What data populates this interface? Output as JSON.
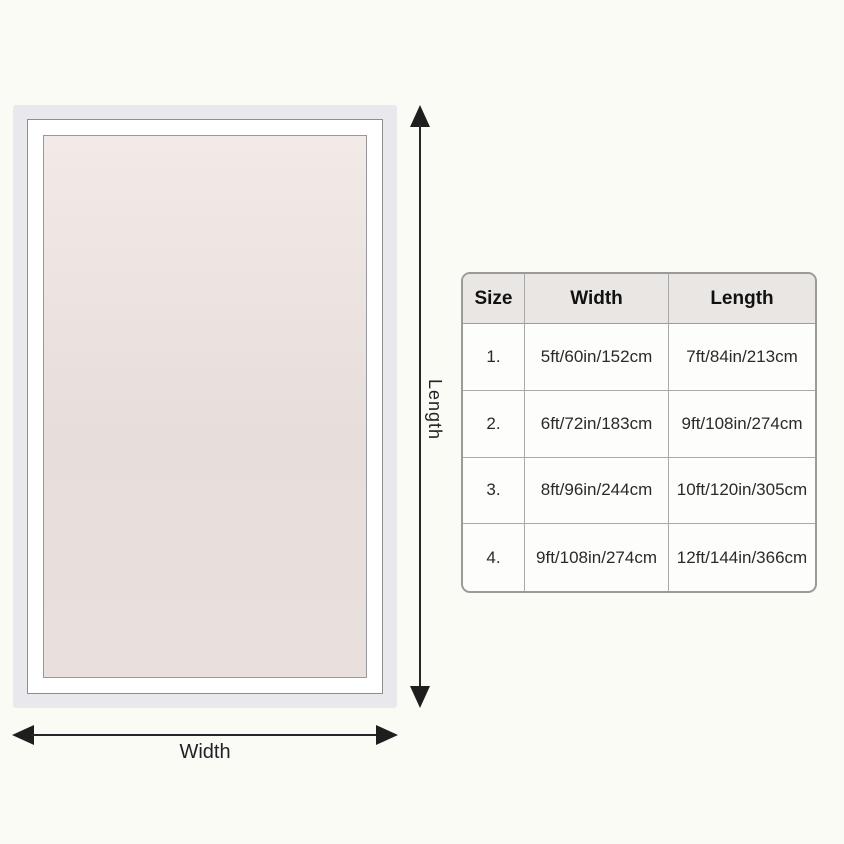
{
  "page": {
    "background": "#fbfbf5"
  },
  "diagram": {
    "length_label": "Length",
    "width_label": "Width",
    "colors": {
      "outer_band": "#e9e9ed",
      "middle_band": "#ffffff",
      "inner_fill": "#ece2df",
      "frame_line": "#8d8d92",
      "arrow": "#1e1e1e"
    }
  },
  "size_table": {
    "headers": [
      "Size",
      "Width",
      "Length"
    ],
    "rows": [
      {
        "size": "1.",
        "width": "5ft/60in/152cm",
        "length": "7ft/84in/213cm"
      },
      {
        "size": "2.",
        "width": "6ft/72in/183cm",
        "length": "9ft/108in/274cm"
      },
      {
        "size": "3.",
        "width": "8ft/96in/244cm",
        "length": "10ft/120in/305cm"
      },
      {
        "size": "4.",
        "width": "9ft/108in/274cm",
        "length": "12ft/144in/366cm"
      }
    ],
    "colors": {
      "border": "#9a9a9a",
      "grid_line": "#a9a9a9",
      "header_bg": "#e9e6e3",
      "cell_bg": "#fdfdfb",
      "text": "#2a2a2a"
    }
  }
}
